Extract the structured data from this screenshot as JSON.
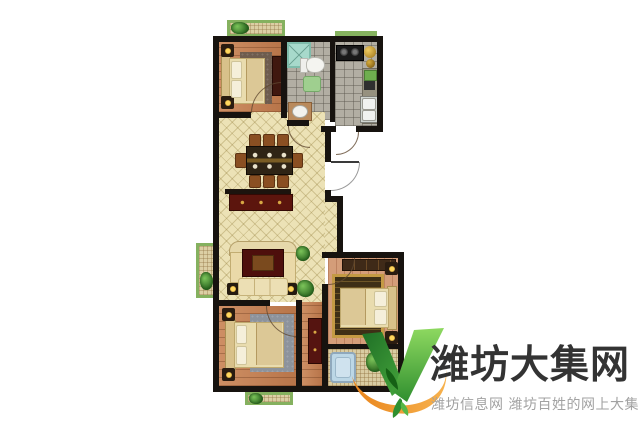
{
  "watermark": {
    "title": "潍坊大集网",
    "subtitle": "潍坊信息网 潍坊百姓的网上大集",
    "title_color": "#333333",
    "subtitle_color": "#a2a2a2",
    "logo_colors": {
      "green_dark": "#1f6f26",
      "green_light": "#8ed960",
      "orange": "#f09224"
    }
  },
  "floorplan": {
    "type": "apartment-floor-plan",
    "background": "#ffffff",
    "wall_color": "#17130f",
    "palette": {
      "tile_floor": "#ece2b6",
      "wood_floor": "#c37c4e",
      "wood_floor_light": "#d49d79",
      "gray_tile": "#b2aea3",
      "mosaic": "#d9cca2",
      "balcony_green": "#85b15f",
      "shower_teal": "#a7d9cb",
      "tub_blue": "#bcd7e6",
      "rug_red": "#5c150d",
      "cabinet_red": "#551410",
      "bed_cream": "#e9dcae",
      "lamp_yellow": "#ffd75e",
      "plant_green": "#2e6b22"
    },
    "rooms": [
      {
        "id": "bedroom-top-left",
        "type": "bedroom",
        "furniture": [
          "bed",
          "rug",
          "nightstand-lamp",
          "nightstand-lamp",
          "wardrobe"
        ]
      },
      {
        "id": "bathroom-top",
        "type": "bathroom",
        "furniture": [
          "shower",
          "toilet",
          "bath-mat",
          "vanity-basin"
        ]
      },
      {
        "id": "kitchen-top-right",
        "type": "kitchen",
        "furniture": [
          "stove",
          "pots",
          "counter",
          "cutting-board",
          "double-sink"
        ]
      },
      {
        "id": "dining-room",
        "type": "dining",
        "furniture": [
          "dining-table",
          "chairs-x8",
          "sideboard"
        ]
      },
      {
        "id": "living-room",
        "type": "living",
        "furniture": [
          "tv-wall",
          "sofa",
          "rug",
          "lamps",
          "plants"
        ]
      },
      {
        "id": "bedroom-bottom-left",
        "type": "bedroom",
        "furniture": [
          "bed",
          "rug",
          "nightstand-lamp",
          "nightstand-lamp"
        ]
      },
      {
        "id": "hallway",
        "type": "hall",
        "furniture": [
          "wardrobe"
        ]
      },
      {
        "id": "bedroom-bottom-right",
        "type": "bedroom",
        "furniture": [
          "bed",
          "ornate-rug",
          "wardrobe",
          "nightstand-lamp",
          "nightstand-lamp"
        ]
      },
      {
        "id": "bathroom-bottom-right",
        "type": "bathroom",
        "furniture": [
          "bathtub",
          "plant"
        ]
      },
      {
        "id": "balcony-top",
        "type": "balcony",
        "furniture": [
          "plants"
        ]
      },
      {
        "id": "balcony-left",
        "type": "balcony",
        "furniture": [
          "plant"
        ]
      },
      {
        "id": "balcony-bottom",
        "type": "balcony",
        "furniture": [
          "plant"
        ]
      }
    ],
    "doors": [
      "entrance-door-right",
      "bedroom-tl-door",
      "bedroom-bl-door",
      "bedroom-br-door",
      "bathroom-door",
      "kitchen-door"
    ]
  }
}
